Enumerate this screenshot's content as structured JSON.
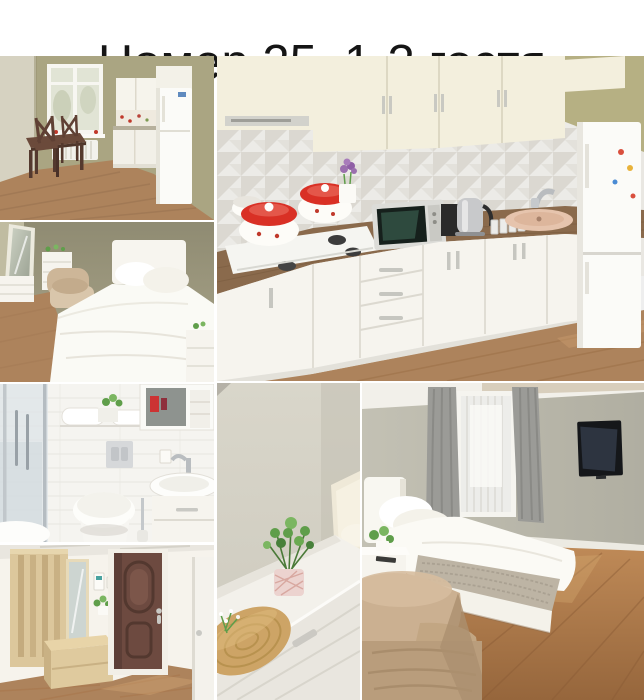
{
  "header": {
    "title": "Номер 25, 1-3 гостя"
  },
  "collage": {
    "photos": [
      {
        "name": "photo-kitchen-dining",
        "label": "Kitchen corner with dining table, chairs and window"
      },
      {
        "name": "photo-kitchen-main",
        "label": "White kitchen with gas hob, red pots, microwave, kettle, sink and fridge"
      },
      {
        "name": "photo-bedroom-white",
        "label": "Bedroom with white double bed, mirror, dresser and armchair"
      },
      {
        "name": "photo-bathroom",
        "label": "Bathroom with shower cabin, towels, toilet, mirror cabinet and sink"
      },
      {
        "name": "photo-hallway",
        "label": "Hallway with wooden wardrobe, mirror, bench and brown entrance door"
      },
      {
        "name": "photo-dresser-closeup",
        "label": "White chest of drawers with green plant and wicker tray"
      },
      {
        "name": "photo-bedroom-tv",
        "label": "Bedroom with bed, window with grey curtains, wall TV and armchair"
      }
    ]
  },
  "colors": {
    "titleText": "#151515",
    "seam": "#ffffff",
    "wallOliveA": "#aaa582",
    "wallOliveC": "#a49f86",
    "wallSageG": "#b8b6a9",
    "wallGrayF": "#d5d2c6",
    "bathTile": "#f5f4f0",
    "hallWall": "#f6f3ec",
    "floorWood": "#ad835c",
    "floorDeep": "#9c6a42",
    "counterWood": "#8a6a4c",
    "cabinetCream": "#f3efdd",
    "furnWhite": "#f6f4ee",
    "fridgeWhite": "#fbfbf8",
    "doorBrown": "#6d4a40",
    "birch": "#dcc79c",
    "potLidRed": "#d93025",
    "plantGreen": "#5f9e4a",
    "curtainGray": "#9b9b97",
    "tanChair": "#c8ad8d",
    "wicker": "#cda466",
    "tvBlack": "#15171a",
    "backsplash": "#e9e7e2",
    "beigeSink": "#e6c4ad"
  }
}
